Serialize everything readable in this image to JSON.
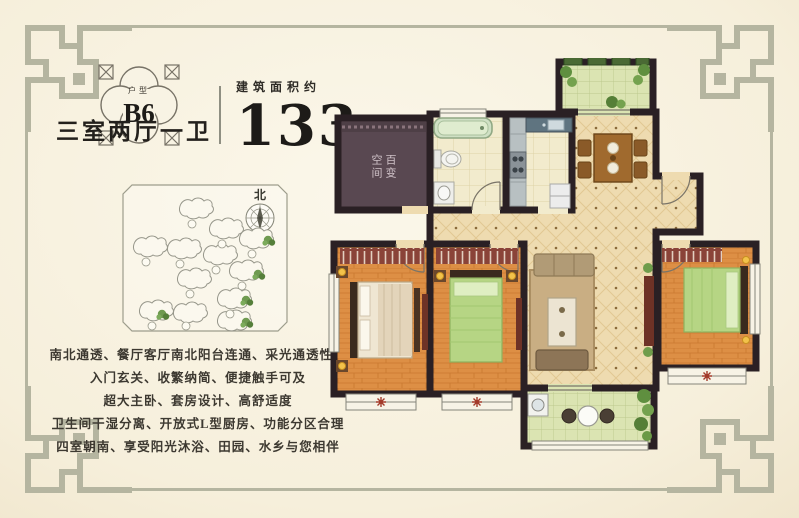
{
  "header": {
    "badge": {
      "small_label": "户型",
      "code": "B6"
    },
    "unit_type": "三室两厅一卫",
    "area_label": "建筑面积约",
    "area_value": "133",
    "area_unit": "m",
    "area_unit_sup": "2"
  },
  "site_map": {
    "compass_label": "北"
  },
  "floor_plan": {
    "flex_room_label": "百变空间",
    "flex_room_col_right": "百变",
    "flex_room_col_left": "空间"
  },
  "features": {
    "lines": [
      "南北通透、餐厅客厅南北阳台连通、采光通透性好",
      "入门玄关、收繁纳简、便捷触手可及",
      "超大主卧、套房设计、高舒适度",
      "卫生间干湿分离、开放式L型厨房、功能分区合理",
      "四室朝南、享受阳光沐浴、田园、水乡与您相伴"
    ]
  },
  "colors": {
    "frame": "#b5b5a0",
    "wall": "#2a2024",
    "wood_floor": "#dd8f45",
    "tile_floor": "#f2ebcd",
    "balcony_floor": "#dbe4b2",
    "open_floor": "#eedbb0",
    "flex_room": "#594851",
    "accent_red": "#8a4338",
    "lamp_gold": "#f2c24a"
  }
}
